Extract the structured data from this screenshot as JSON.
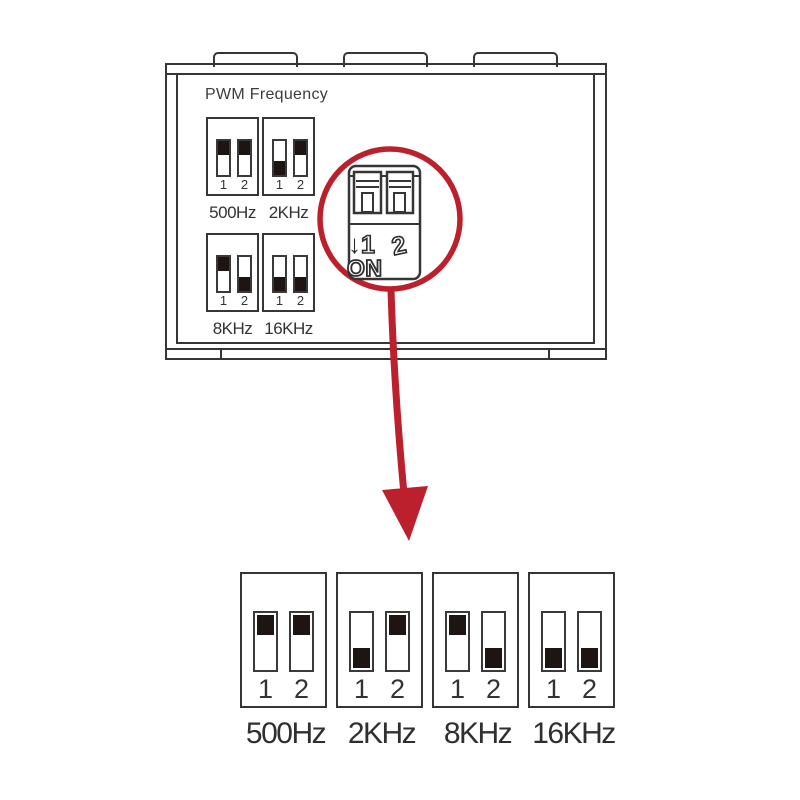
{
  "diagram_title": "PWM Frequency DIP switch settings",
  "colors": {
    "line": "#363636",
    "slider_block": "#1e1513",
    "callout_red": "#bc202c",
    "background": "#ffffff"
  },
  "device": {
    "label": "PWM Frequency",
    "mini_panels": [
      {
        "label": "500Hz",
        "pins": [
          "1",
          "2"
        ],
        "positions": [
          "up",
          "up"
        ]
      },
      {
        "label": "2KHz",
        "pins": [
          "1",
          "2"
        ],
        "positions": [
          "down",
          "up"
        ]
      },
      {
        "label": "8KHz",
        "pins": [
          "1",
          "2"
        ],
        "positions": [
          "up",
          "down"
        ]
      },
      {
        "label": "16KHz",
        "pins": [
          "1",
          "2"
        ],
        "positions": [
          "down",
          "down"
        ]
      }
    ]
  },
  "callout": {
    "down_arrow": "↓",
    "pin1": "1",
    "pin2": "2",
    "on_label": "ON"
  },
  "detail_panels": [
    {
      "label": "500Hz",
      "pins": [
        "1",
        "2"
      ],
      "positions": [
        "up",
        "up"
      ]
    },
    {
      "label": "2KHz",
      "pins": [
        "1",
        "2"
      ],
      "positions": [
        "down",
        "up"
      ]
    },
    {
      "label": "8KHz",
      "pins": [
        "1",
        "2"
      ],
      "positions": [
        "up",
        "down"
      ]
    },
    {
      "label": "16KHz",
      "pins": [
        "1",
        "2"
      ],
      "positions": [
        "down",
        "down"
      ]
    }
  ]
}
